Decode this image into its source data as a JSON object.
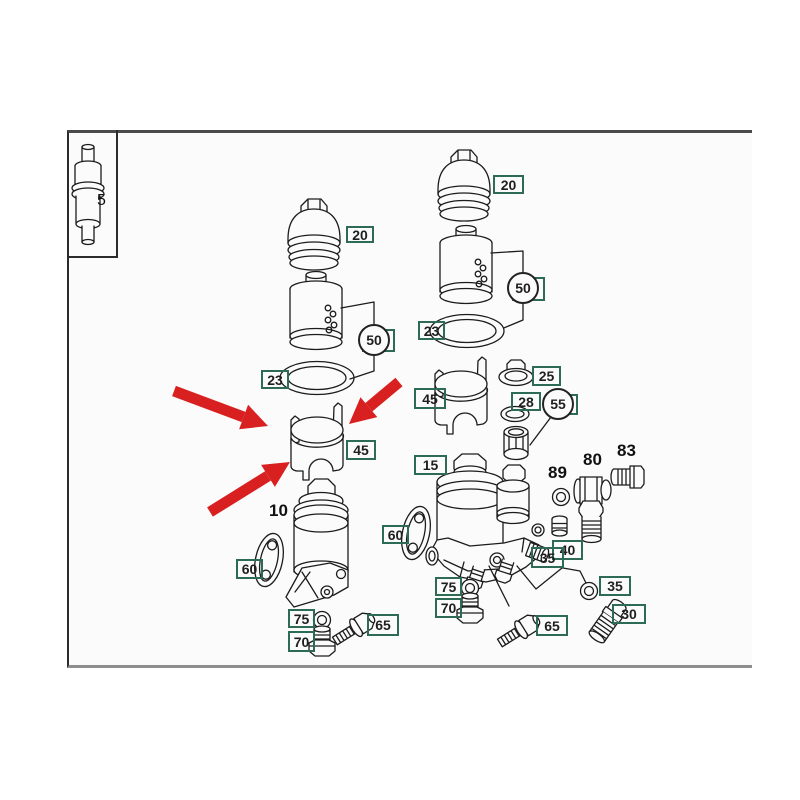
{
  "figure": {
    "type": "exploded-parts-diagram",
    "subject": "oil-filter-housing-assembly",
    "arrows_point_to": "45"
  },
  "labels": {
    "n5": "5",
    "n10": "10",
    "n15": "15",
    "n20": "20",
    "n23": "23",
    "n25": "25",
    "n28": "28",
    "n30": "30",
    "n35": "35",
    "n40": "40",
    "n45": "45",
    "n50": "50",
    "n55": "55",
    "n60": "60",
    "n65": "65",
    "n70": "70",
    "n75": "75",
    "n80": "80",
    "n83": "83",
    "n89": "89"
  },
  "colors": {
    "label_box_green": "#2e6b55",
    "arrow_red": "#d92020",
    "line_black": "#1c1c1c",
    "canvas_bg": "#fbfbfb",
    "border_gray": "#8e8e8e"
  }
}
